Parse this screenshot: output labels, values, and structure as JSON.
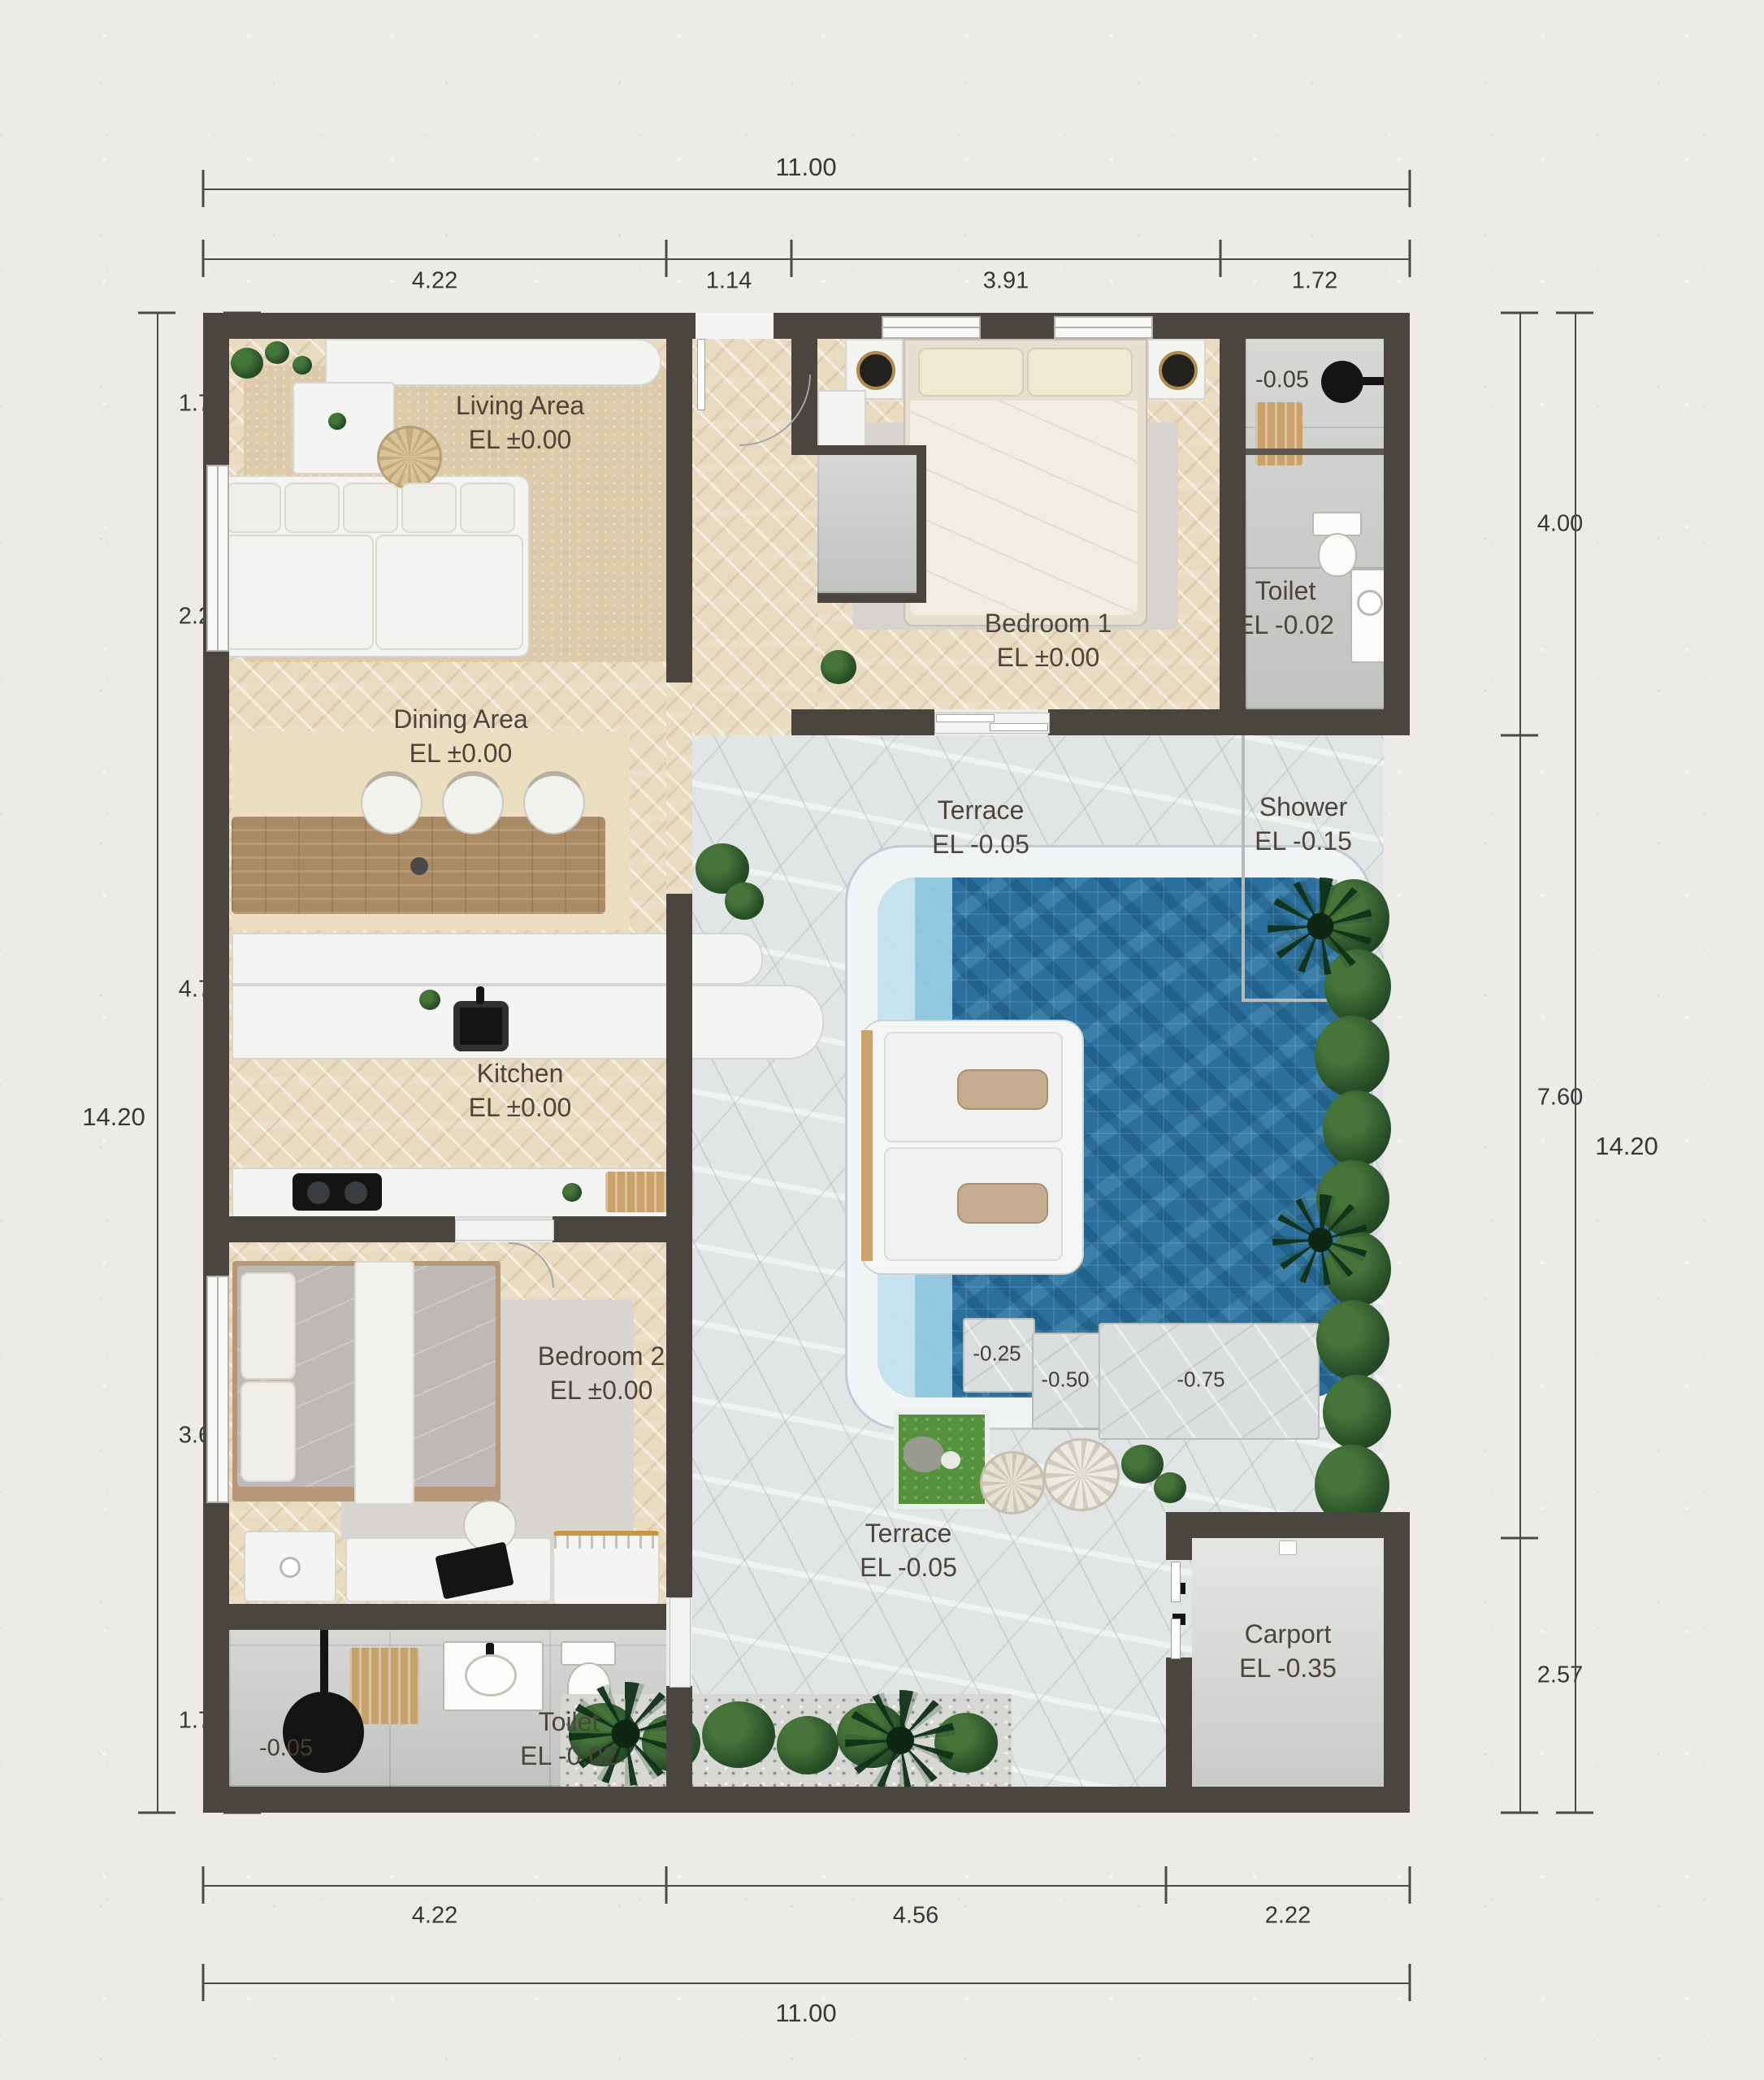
{
  "plan": {
    "dims": {
      "top_total": "11.00",
      "top_segs": [
        "4.22",
        "1.14",
        "3.91",
        "1.72"
      ],
      "bottom_total": "11.00",
      "bottom_segs": [
        "4.22",
        "4.56",
        "2.22"
      ],
      "left_total": "14.20",
      "left_segs": [
        "1.73",
        "2.29",
        "4.78",
        "3.67",
        "1.72"
      ],
      "right_total": "14.20",
      "right_segs": [
        "4.00",
        "7.60",
        "2.57"
      ]
    },
    "rooms": {
      "living": {
        "name": "Living Area",
        "el": "EL ±0.00"
      },
      "dining": {
        "name": "Dining Area",
        "el": "EL ±0.00"
      },
      "kitchen": {
        "name": "Kitchen",
        "el": "EL ±0.00"
      },
      "bedroom1": {
        "name": "Bedroom 1",
        "el": "EL ±0.00"
      },
      "toilet1": {
        "name": "Toilet",
        "el": "EL -0.02",
        "mark": "-0.05"
      },
      "shower": {
        "name": "Shower",
        "el": "EL -0.15"
      },
      "terrace_upper": {
        "name": "Terrace",
        "el": "EL -0.05"
      },
      "terrace_lower": {
        "name": "Terrace",
        "el": "EL -0.05"
      },
      "bedroom2": {
        "name": "Bedroom 2",
        "el": "EL ±0.00"
      },
      "toilet2": {
        "name": "Toilet",
        "el": "EL -0.02",
        "mark": "-0.05"
      },
      "carport": {
        "name": "Carport",
        "el": "EL -0.35"
      }
    },
    "pool_marks": {
      "m025": "-0.25",
      "m050": "-0.50",
      "m075": "-0.75"
    },
    "colors": {
      "wall": "#4b453f",
      "wood": "#e8dbc0",
      "stone": "#e1e5e5",
      "water": "#2b6f9c",
      "dim_text": "#373737"
    }
  }
}
